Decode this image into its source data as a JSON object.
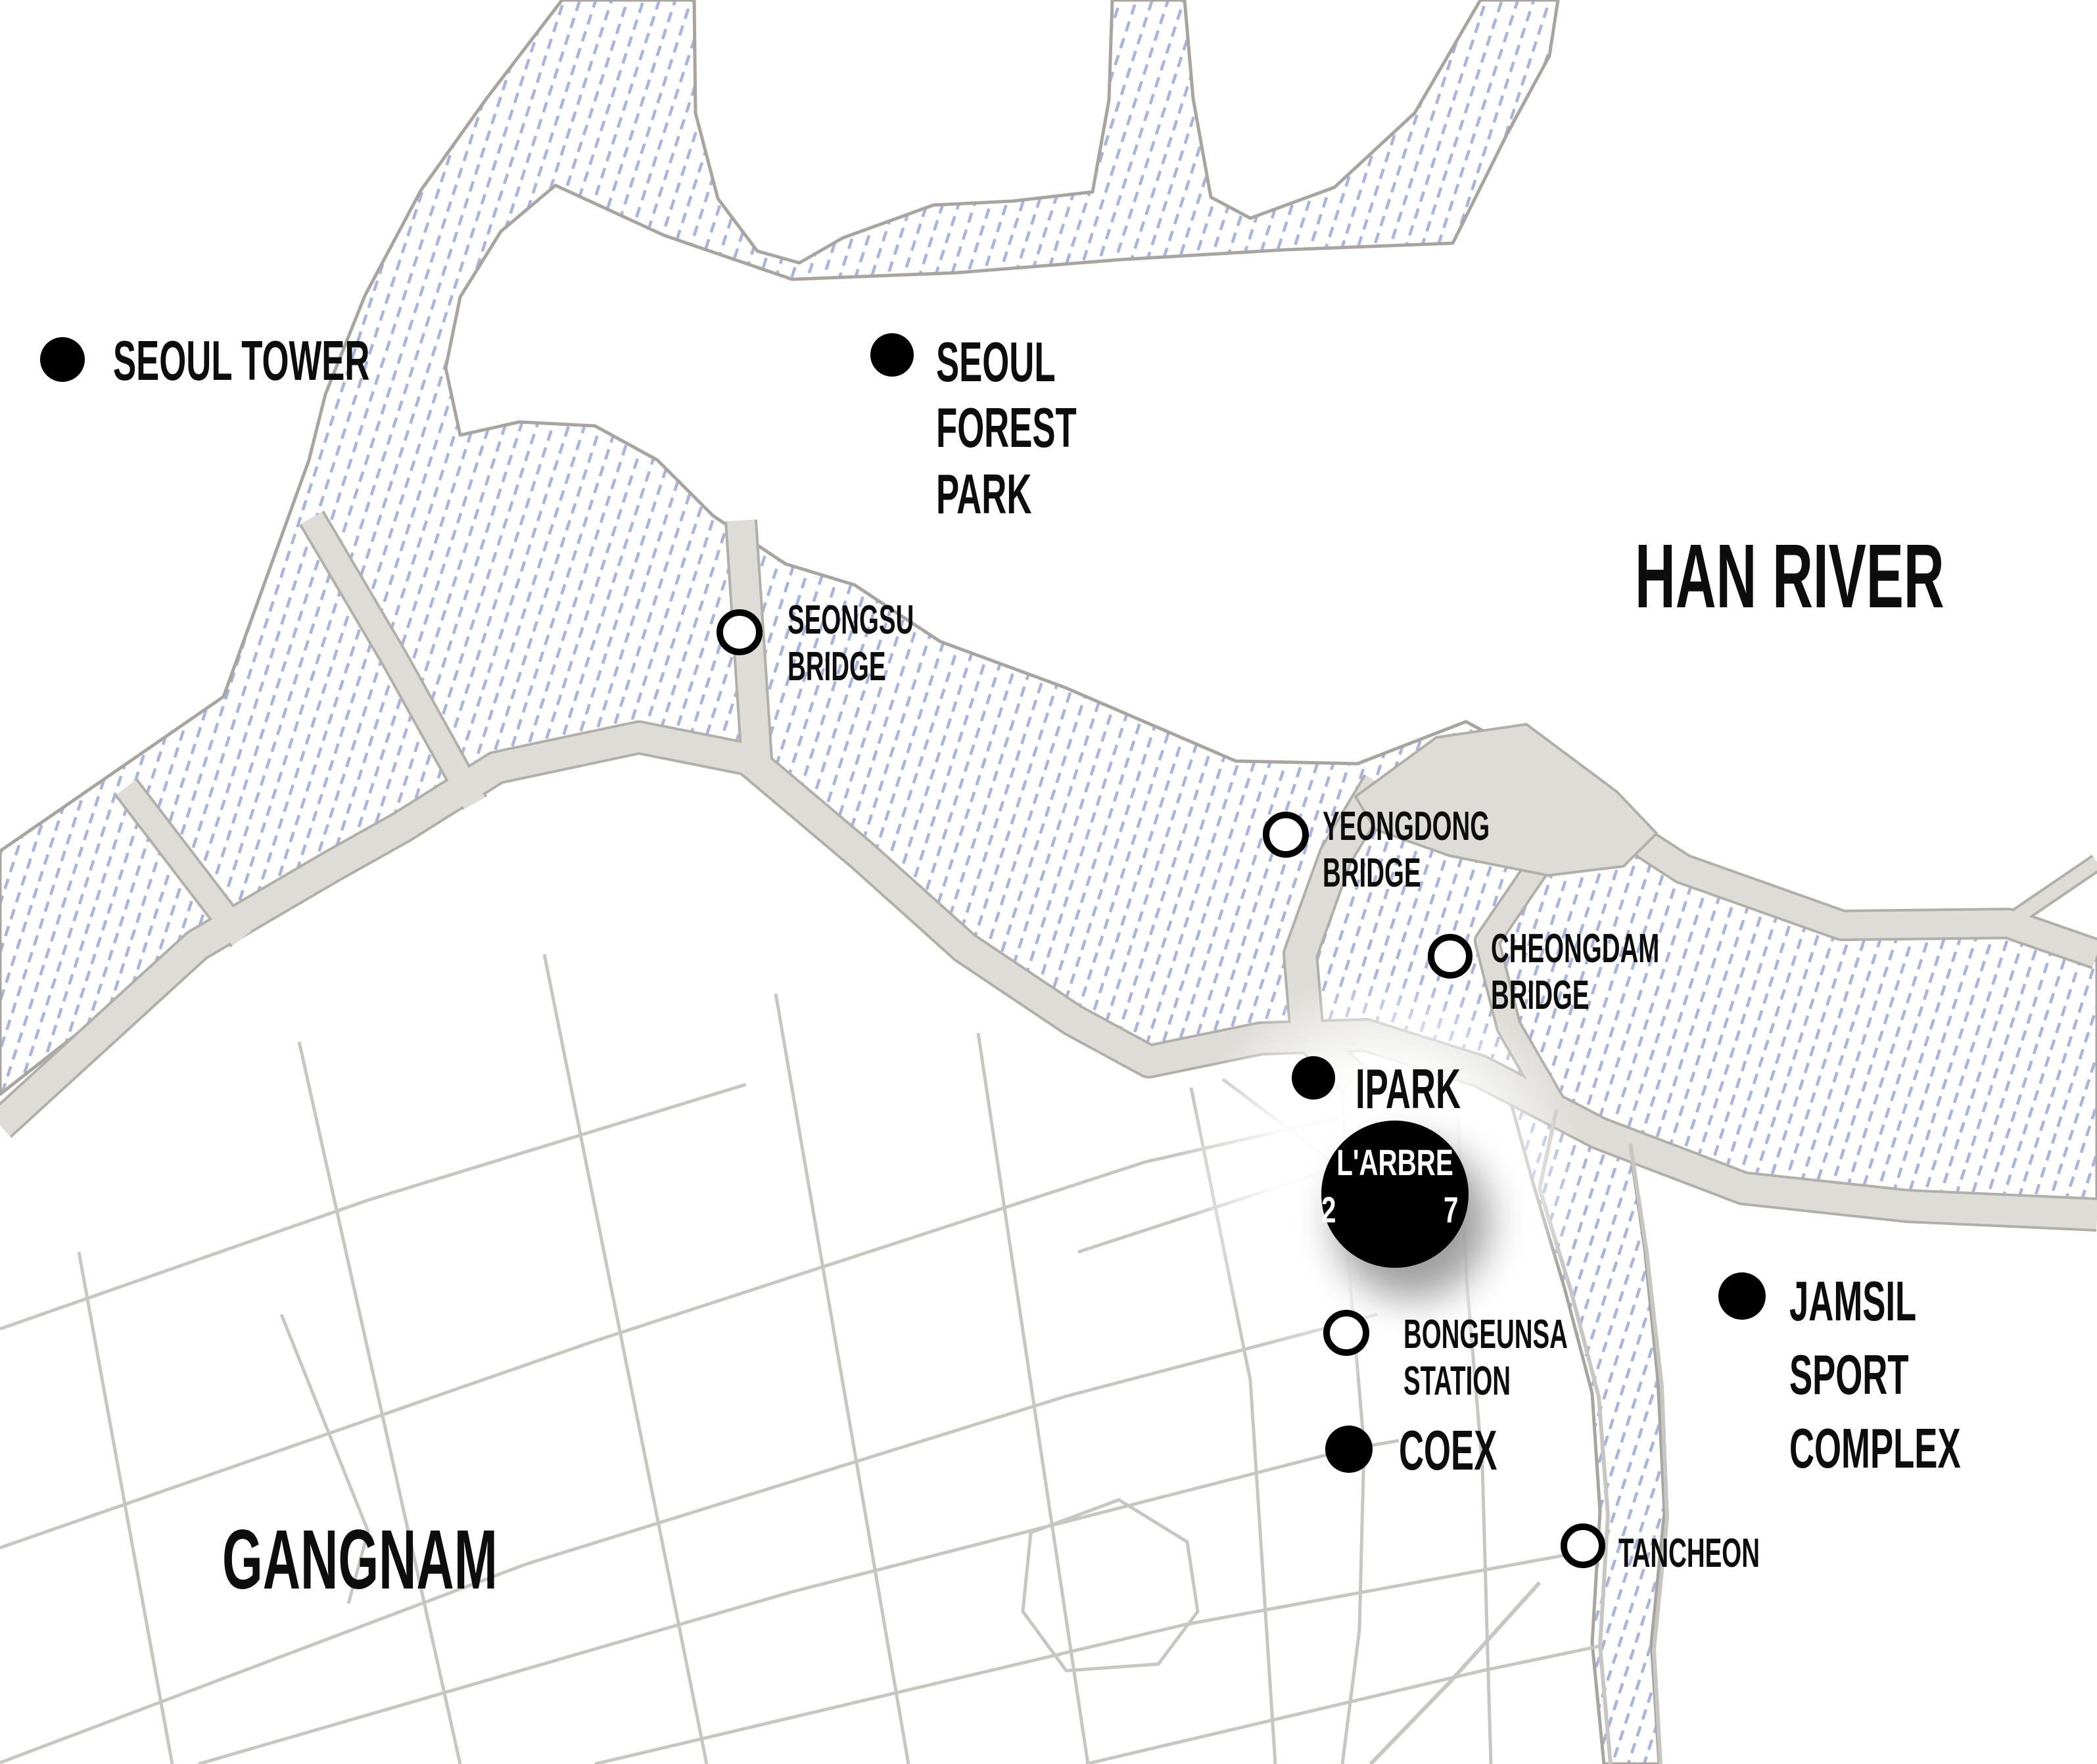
{
  "map_title": "Seoul / Gangnam location map",
  "colors": {
    "background": "#ffffff",
    "water_hatch": "#aab4da",
    "water_outline": "#a8a5a0",
    "road_fill": "#dddcd7",
    "road_casing": "#b2afaa",
    "street_line": "#c7c6c3",
    "marker_black": "#000000",
    "label_text": "#0d0d0d",
    "badge_text": "#ffffff"
  },
  "landmarks": {
    "seoul_tower": {
      "lines": [
        "SEOUL TOWER"
      ],
      "marker": "dot"
    },
    "seoul_forest_park": {
      "lines": [
        "SEOUL",
        "FOREST",
        "PARK"
      ],
      "marker": "dot"
    },
    "han_river": {
      "lines": [
        "HAN RIVER"
      ],
      "marker": "none"
    },
    "seongsu_bridge": {
      "lines": [
        "SEONGSU",
        "BRIDGE"
      ],
      "marker": "open-circle"
    },
    "yeongdong_bridge": {
      "lines": [
        "YEONGDONG",
        "BRIDGE"
      ],
      "marker": "open-circle"
    },
    "cheongdam_bridge": {
      "lines": [
        "CHEONGDAM",
        "BRIDGE"
      ],
      "marker": "open-circle"
    },
    "ipark": {
      "lines": [
        "IPARK"
      ],
      "marker": "dot"
    },
    "bongeunsa_station": {
      "lines": [
        "BONGEUNSA",
        "STATION"
      ],
      "marker": "open-circle"
    },
    "coex": {
      "lines": [
        "COEX"
      ],
      "marker": "dot"
    },
    "jamsil_sport_complex": {
      "lines": [
        "JAMSIL",
        "SPORT",
        "COMPLEX"
      ],
      "marker": "dot"
    },
    "tancheon": {
      "lines": [
        "TANCHEON"
      ],
      "marker": "open-circle"
    },
    "gangnam": {
      "lines": [
        "GANGNAM"
      ],
      "marker": "none"
    }
  },
  "main_marker": {
    "title": "L'ARBRE",
    "digit_left": "2",
    "digit_right": "7"
  }
}
